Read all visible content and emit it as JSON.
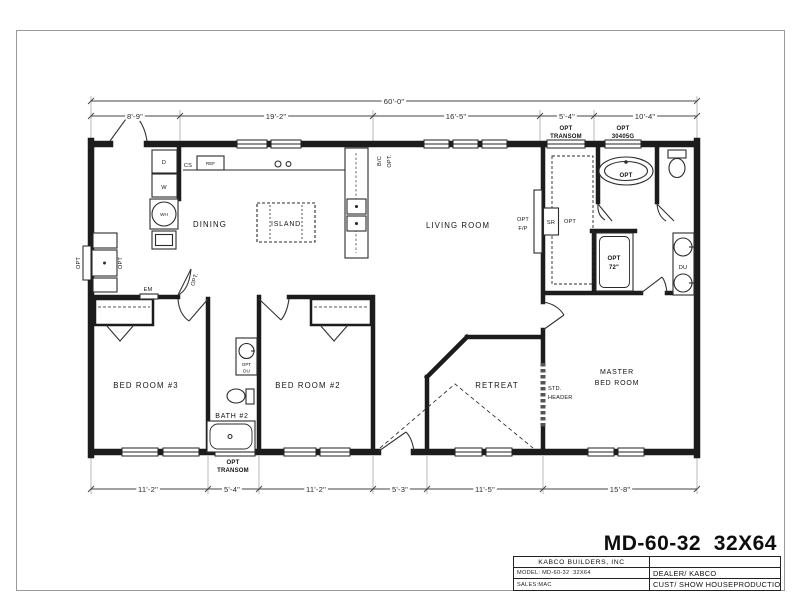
{
  "page": {
    "title": "MD-60-32  32X64"
  },
  "title_block": {
    "company": "KABCO BUILDERS, INC",
    "model": "MODEL: MD-60-32  32X64",
    "sales": "SALES:MAC",
    "dealer": "DEALER/ KABCO",
    "customer": "CUST/ SHOW HOUSE",
    "status": "PRODUCTION"
  },
  "dims": {
    "overall": "60'-0\"",
    "top": [
      "8'-9\"",
      "19'-2\"",
      "16'-5\"",
      "5'-4\"",
      "10'-4\""
    ],
    "bottom": [
      "11'-2\"",
      "5'-4\"",
      "11'-2\"",
      "5'-3\"",
      "11'-5\"",
      "15'-8\""
    ]
  },
  "rooms": {
    "dining": "DINING",
    "living": "LIVING ROOM",
    "bed3": "BED ROOM #3",
    "bed2": "BED ROOM #2",
    "bath2": "BATH #2",
    "retreat": "RETREAT",
    "master1": "MASTER",
    "master2": "BED ROOM"
  },
  "labels": {
    "island": "ISLAND",
    "dryer": "D",
    "washer": "W",
    "water_heater": "WH",
    "cs": "CS",
    "ref": "REF",
    "em": "EM",
    "opt": "OPT",
    "opt_period": "OPT.",
    "bc": "B/C",
    "fp1": "OPT",
    "fp2": "F/P",
    "sr": "SR",
    "sr_opt": "OPT",
    "tub_opt": "OPT",
    "du": "DU",
    "shower1": "OPT",
    "shower2": "72\"",
    "optdu1": "OPT",
    "optdu2": "DU",
    "transom1": "OPT",
    "transom2": "TRANSOM",
    "glass1": "OPT",
    "glass2": "30405G",
    "btransom1": "OPT",
    "btransom2": "TRANSOM",
    "hdr1": "STD.",
    "hdr2": "HEADER"
  }
}
